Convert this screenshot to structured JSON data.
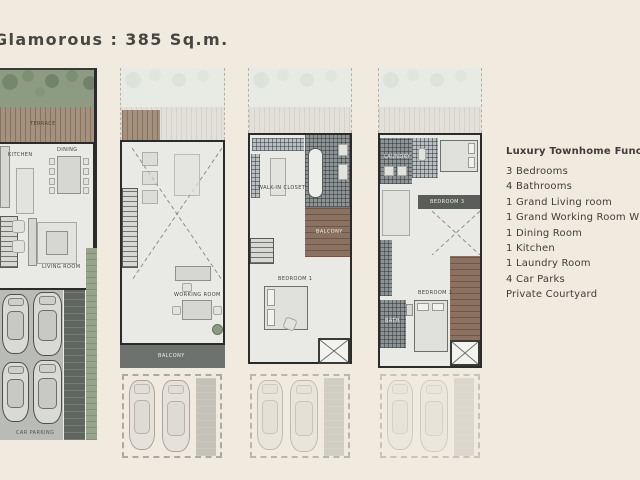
{
  "page": {
    "title": "Glamorous : 385 Sq.m."
  },
  "features": {
    "heading": "Luxury Townhome Function :",
    "items": [
      "3 Bedrooms",
      "4 Bathrooms",
      "1 Grand Living room",
      "1 Grand Working Room With",
      "1 Dining Room",
      "1 Kitchen",
      "1 Laundry Room",
      "4 Car Parks",
      "Private Courtyard"
    ]
  },
  "plans": {
    "ground": {
      "terrace": "TERRACE",
      "kitchen": "KITCHEN",
      "dining": "DINING",
      "living": "LIVING ROOM",
      "parking": "CAR PARKING"
    },
    "second": {
      "working": "WORKING ROOM",
      "balcony": "BALCONY"
    },
    "third": {
      "closet": "WALK-IN CLOSET",
      "balcony": "BALCONY",
      "bedroom1": "BEDROOM 1"
    },
    "fourth": {
      "laundry": "LAUNDRY",
      "bedroom3": "BEDROOM 3",
      "bedroom2": "BEDROOM 2",
      "bath": "BATH"
    }
  },
  "colors": {
    "background": "#f1ebdf",
    "courtyard_green": "#8d9b83",
    "terrace_wood": "#a3907d",
    "wall": "#2b2b2b",
    "floor": "#e9e9e6",
    "parking_gray": "#b9bbb7",
    "tile_dark": "#5f655f",
    "deck_wood": "#8a7160",
    "text": "#3e3d39"
  }
}
